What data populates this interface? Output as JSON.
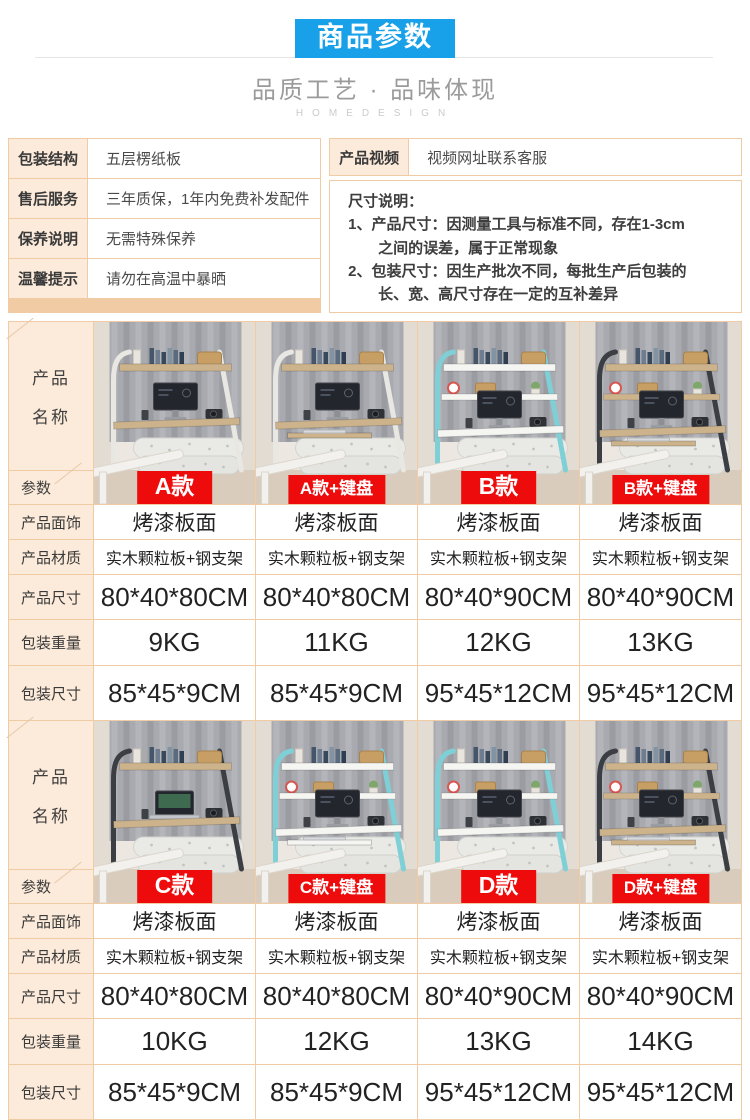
{
  "header": {
    "title": "商品参数",
    "tagline": "品质工艺 · 品味体现",
    "brand": "HOMEDESIGN"
  },
  "theme": {
    "accent_blue": "#18A0E8",
    "badge_red": "#EE0B0C",
    "border_tan": "#F0CBA4",
    "label_bg": "#FCEBDA"
  },
  "info": {
    "left_rows": [
      {
        "label": "包装结构",
        "value": "五层楞纸板"
      },
      {
        "label": "售后服务",
        "value": "三年质保，1年内免费补发配件"
      },
      {
        "label": "保养说明",
        "value": "无需特殊保养"
      },
      {
        "label": "温馨提示",
        "value": "请勿在高温中暴晒"
      }
    ],
    "video": {
      "label": "产品视频",
      "value": "视频网址联系客服"
    },
    "size_note": {
      "title": "尺寸说明：",
      "lines": [
        "1、产品尺寸：因测量工具与标准不同，存在1-3cm",
        "之间的误差，属于正常现象",
        "2、包装尺寸：因生产批次不同，每批生产后包装的",
        "长、宽、高尺寸存在一定的互补差异"
      ]
    }
  },
  "table": {
    "name_line1": "产品",
    "name_line2": "名称",
    "param_label": "参数",
    "row_labels": [
      "产品面饰",
      "产品材质",
      "产品尺寸",
      "包装重量",
      "包装尺寸"
    ],
    "sections": [
      {
        "products": [
          {
            "badge": "A款",
            "finish": "烤漆板面",
            "material": "实木颗粒板+钢支架",
            "size": "80*40*80CM",
            "weight": "9KG",
            "pack": "85*45*9CM",
            "image": {
              "frame": "#E8E7E2",
              "board": "#CDB38C",
              "device": "monitor",
              "shelves": 2,
              "tray": false
            }
          },
          {
            "badge": "A款+键盘",
            "finish": "烤漆板面",
            "material": "实木颗粒板+钢支架",
            "size": "80*40*80CM",
            "weight": "11KG",
            "pack": "85*45*9CM",
            "image": {
              "frame": "#E8E7E2",
              "board": "#CDB38C",
              "device": "monitor",
              "shelves": 2,
              "tray": true
            }
          },
          {
            "badge": "B款",
            "finish": "烤漆板面",
            "material": "实木颗粒板+钢支架",
            "size": "80*40*90CM",
            "weight": "12KG",
            "pack": "95*45*12CM",
            "image": {
              "frame": "#7ED0D6",
              "board": "#F5F5F2",
              "device": "monitor",
              "shelves": 3,
              "tray": false
            }
          },
          {
            "badge": "B款+键盘",
            "finish": "烤漆板面",
            "material": "实木颗粒板+钢支架",
            "size": "80*40*90CM",
            "weight": "13KG",
            "pack": "95*45*12CM",
            "image": {
              "frame": "#3B3E43",
              "board": "#CDB38C",
              "device": "monitor",
              "shelves": 3,
              "tray": true
            }
          }
        ]
      },
      {
        "products": [
          {
            "badge": "C款",
            "finish": "烤漆板面",
            "material": "实木颗粒板+钢支架",
            "size": "80*40*80CM",
            "weight": "10KG",
            "pack": "85*45*9CM",
            "image": {
              "frame": "#3B3E43",
              "board": "#CDB38C",
              "device": "laptop",
              "shelves": 2,
              "tray": false
            }
          },
          {
            "badge": "C款+键盘",
            "finish": "烤漆板面",
            "material": "实木颗粒板+钢支架",
            "size": "80*40*80CM",
            "weight": "12KG",
            "pack": "85*45*9CM",
            "image": {
              "frame": "#7ED0D6",
              "board": "#F5F5F2",
              "device": "monitor",
              "shelves": 3,
              "tray": true
            }
          },
          {
            "badge": "D款",
            "finish": "烤漆板面",
            "material": "实木颗粒板+钢支架",
            "size": "80*40*90CM",
            "weight": "13KG",
            "pack": "95*45*12CM",
            "image": {
              "frame": "#7ED0D6",
              "board": "#F5F5F2",
              "device": "monitor",
              "shelves": 3,
              "tray": false
            }
          },
          {
            "badge": "D款+键盘",
            "finish": "烤漆板面",
            "material": "实木颗粒板+钢支架",
            "size": "80*40*90CM",
            "weight": "14KG",
            "pack": "95*45*12CM",
            "image": {
              "frame": "#3B3E43",
              "board": "#CDB38C",
              "device": "monitor",
              "shelves": 3,
              "tray": true
            }
          }
        ]
      }
    ]
  }
}
